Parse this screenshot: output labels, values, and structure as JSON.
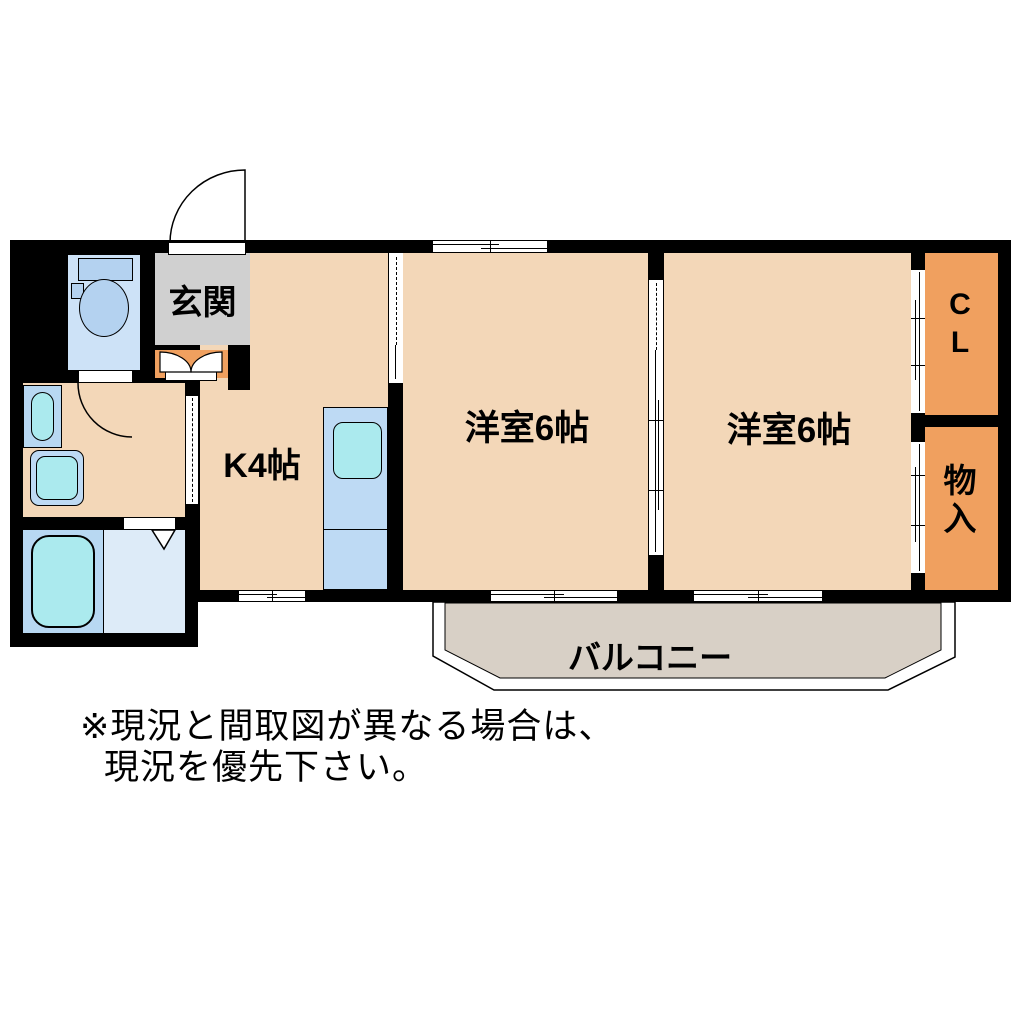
{
  "floorplan": {
    "rooms": {
      "genkan": {
        "label": "玄関"
      },
      "kitchen": {
        "label": "K4帖"
      },
      "room1": {
        "label": "洋室6帖"
      },
      "room2": {
        "label": "洋室6帖"
      },
      "closet": {
        "line1": "C",
        "line2": "L"
      },
      "storage": {
        "line1": "物",
        "line2": "入"
      },
      "balcony": {
        "label": "バルコニー"
      }
    },
    "note": {
      "line1": "※現況と間取図が異なる場合は、",
      "line2": "現況を優先下さい。"
    },
    "colors": {
      "wall": "#000000",
      "room_floor": "#f3d7b8",
      "closet_orange": "#f0a05f",
      "genkan_gray": "#d0d0d0",
      "balcony_gray": "#d8d0c6",
      "fixture_blue": "#b4d2f0",
      "fixture_cyan": "#abeaee",
      "counter_blue": "#bedaf4",
      "toilet_room_blue": "#cde2f7",
      "bath_floor_blue": "#ddebf8",
      "bath_pad_blue": "#b8d8f2"
    }
  }
}
